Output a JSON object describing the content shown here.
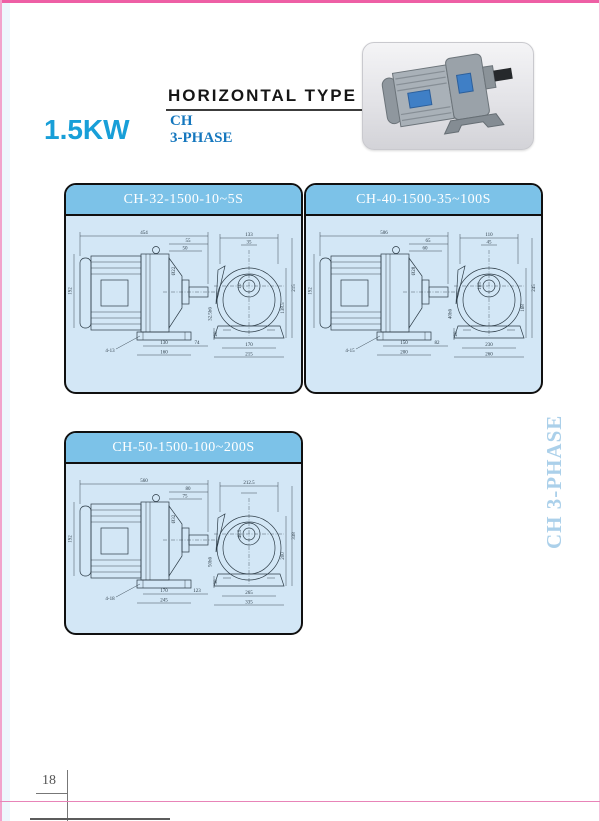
{
  "page": {
    "heading": "HORIZONTAL TYPE",
    "power": "1.5KW",
    "series_line1": "CH",
    "series_line2": "3-PHASE",
    "side_label": "CH 3-PHASE",
    "page_number": "18",
    "accent_blue": "#189fd8",
    "series_blue": "#1577be",
    "panel_header_blue": "#7cc2e8",
    "panel_body_blue": "#d3e7f6",
    "frame_pink": "#ee5fa5",
    "side_label_blue": "#abd0ea"
  },
  "product_photo": {
    "description": "gray horizontal gear motor photo"
  },
  "panels": [
    {
      "title": "CH-32-1500-10~5S",
      "side": {
        "total": "454",
        "height": "192",
        "dia": "Ø22",
        "top1": "55",
        "top2": "50",
        "base_h": "20",
        "bot1": "130",
        "bot3": "74",
        "bot2": "160",
        "foot": "4-13",
        "shaft_end": "32.5h6"
      },
      "front": {
        "top": "133",
        "top2": "35",
        "center_label": "10",
        "right1": "215",
        "right2": "138.5",
        "bot1": "170",
        "bot2": "215"
      }
    },
    {
      "title": "CH-40-1500-35~100S",
      "side": {
        "total": "506",
        "height": "192",
        "dia": "Ø28",
        "top1": "65",
        "top2": "60",
        "base_h": "20",
        "bot1": "150",
        "bot3": "82",
        "bot2": "200",
        "foot": "4-15",
        "shaft_end": "40h6"
      },
      "front": {
        "top": "110",
        "top2": "45",
        "center_label": "105",
        "right1": "245",
        "right2": "168",
        "bot1": "230",
        "bot2": "260"
      }
    },
    {
      "title": "CH-50-1500-100~200S",
      "side": {
        "total": "560",
        "height": "192",
        "dia": "Ø32",
        "top1": "80",
        "top2": "75",
        "base_h": "30",
        "bot1": "170",
        "bot3": "123",
        "bot2": "245",
        "foot": "4-18",
        "shaft_end": "50h6"
      },
      "front": {
        "top": "212.5",
        "top2": "",
        "center_label": "48.5",
        "right1": "338",
        "right2": "200",
        "bot1": "265",
        "bot2": "335"
      }
    }
  ]
}
